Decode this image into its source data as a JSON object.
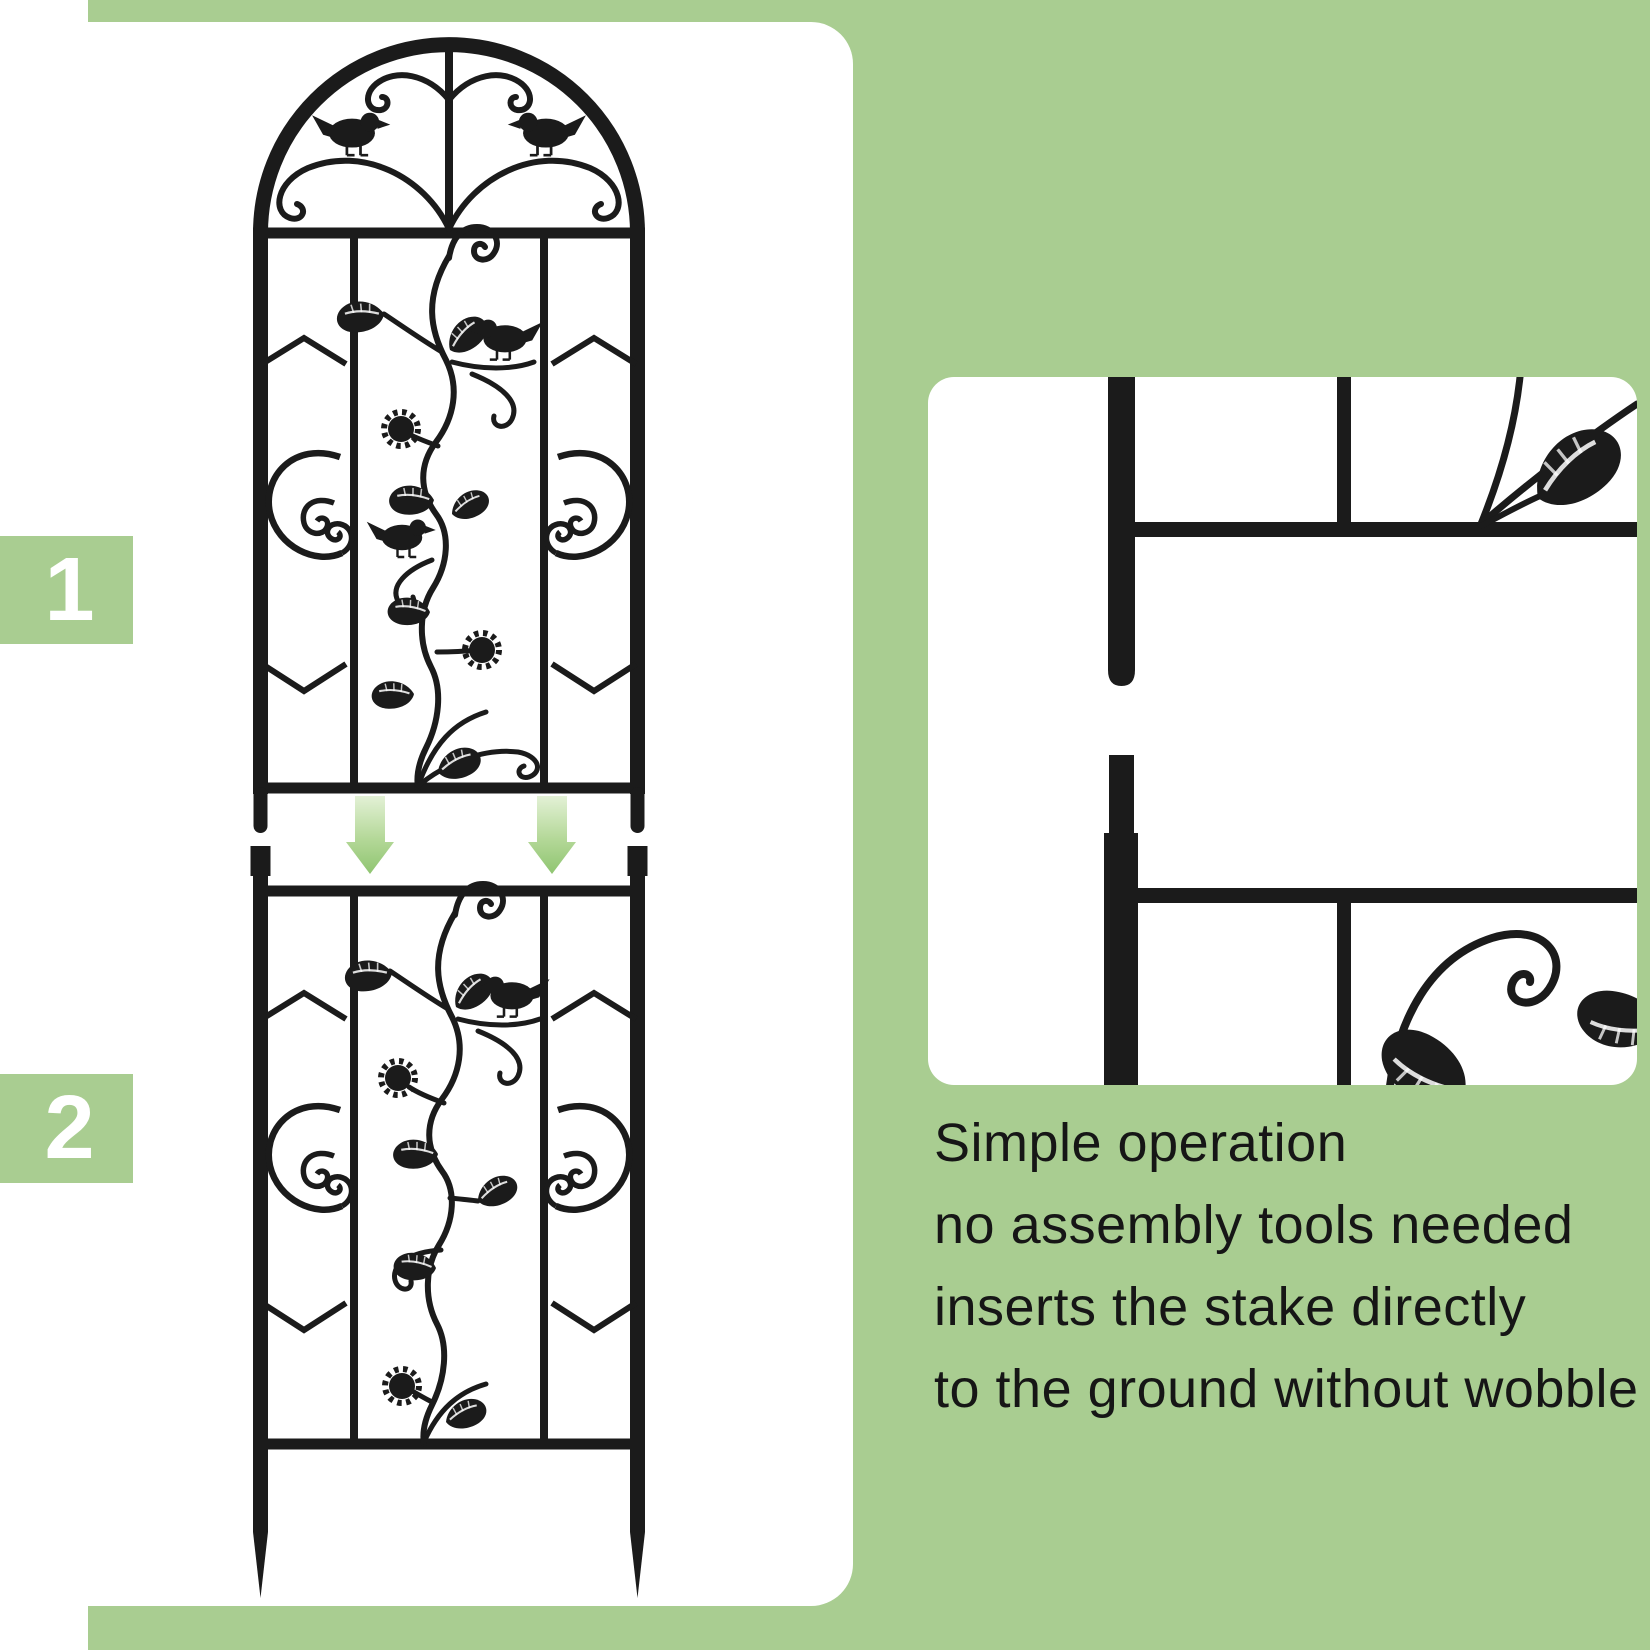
{
  "colors": {
    "background_green": "#a9cd91",
    "panel_white": "#ffffff",
    "metal_black": "#1b1b1b",
    "arrow_green_dark": "#8fc571",
    "arrow_green_light": "#e3f1d6",
    "badge_text": "#ffffff",
    "body_text": "#161616"
  },
  "steps": [
    {
      "number": "1"
    },
    {
      "number": "2"
    }
  ],
  "instructions": {
    "lines": [
      "Simple operation",
      "no assembly tools needed",
      "inserts the stake directly",
      "to the ground without wobble"
    ]
  },
  "icons": {
    "down_arrow": "down-arrow-icon",
    "bird": "bird-icon",
    "leaf": "leaf-icon",
    "flower": "flower-icon"
  }
}
